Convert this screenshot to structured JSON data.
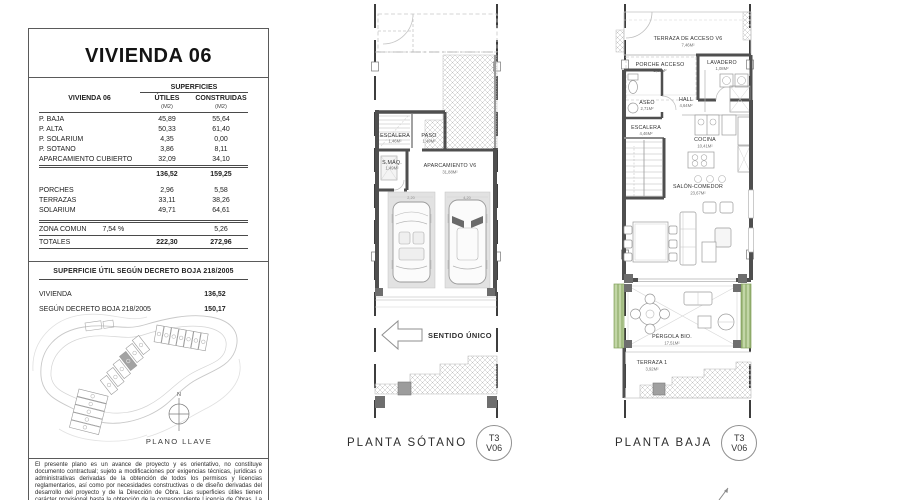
{
  "colors": {
    "wall": "#4f4f4f",
    "hatch": "#bdbdbd",
    "parking_fill": "#e2e2e2",
    "vegetation_green": "#c2d6a6",
    "vegetation_green_line": "#7d9b57",
    "highlight_plot": "#a3a3a3"
  },
  "panel": {
    "title": "VIVIENDA 06",
    "table": {
      "group_header": "SUPERFICIES",
      "row_header": "VIVIENDA 06",
      "col1_header": "ÚTILES",
      "col2_header": "CONSTRUIDAS",
      "unit": "(M2)",
      "rows": [
        {
          "label": "P. BAJA",
          "utiles": "45,89",
          "construidas": "55,64"
        },
        {
          "label": "P. ALTA",
          "utiles": "50,33",
          "construidas": "61,40"
        },
        {
          "label": "P. SOLÁRIUM",
          "utiles": "4,35",
          "construidas": "0,00"
        },
        {
          "label": "P. SÓTANO",
          "utiles": "3,86",
          "construidas": "8,11"
        },
        {
          "label": "APARCAMIENTO CUBIERTO",
          "utiles": "32,09",
          "construidas": "34,10"
        }
      ],
      "subtotal": {
        "utiles": "136,52",
        "construidas": "159,25"
      },
      "rows_outdoor": [
        {
          "label": "PORCHES",
          "utiles": "2,96",
          "construidas": "5,58"
        },
        {
          "label": "TERRAZAS",
          "utiles": "33,11",
          "construidas": "38,26"
        },
        {
          "label": "SOLÁRIUM",
          "utiles": "49,71",
          "construidas": "64,61"
        }
      ],
      "zona_comun": {
        "label": "ZONA COMÚN",
        "pct": "7,54 %",
        "construidas": "5,26"
      },
      "totals": {
        "label": "TOTALES",
        "utiles": "222,30",
        "construidas": "272,96"
      }
    },
    "decreto": {
      "title": "SUPERFICIE ÚTIL SEGÚN DECRETO BOJA 218/2005",
      "rows": [
        {
          "label": "VIVIENDA",
          "value": "136,52"
        },
        {
          "label": "SEGÚN DECRETO BOJA 218/2005",
          "value": "150,17"
        }
      ]
    },
    "key_plan": {
      "north_label": "N",
      "caption": "PLANO LLAVE"
    },
    "disclaimer": "El presente plano es un avance de proyecto y es orientativo, no constituye documento contractual; sujeto a modificaciones por exigencias técnicas, jurídicas o administrativas derivadas de la obtención de todos los permisos y licencias reglamentarios, así como por necesidades constructivas o de diseño derivadas del desarrollo del proyecto y de la Dirección de Obra. Las superficies útiles tienen carácter provisional hasta la obtención de la correspondiente Licencia de Obras. La jardinería, el mobiliario"
  },
  "plan_sotano": {
    "caption": "PLANTA SÓTANO",
    "badge": {
      "type": "T3",
      "unit": "V06"
    },
    "direction_label": "SENTIDO ÚNICO",
    "rooms": [
      {
        "name": "ESCALERA",
        "area": "1,46M²"
      },
      {
        "name": "PASO",
        "area": "1,49M²"
      },
      {
        "name": "S.MÁQ.",
        "area": "1,49M²"
      },
      {
        "name": "APARCAMIENTO V6",
        "area": "31,88M²"
      }
    ],
    "dims": [
      "2,20",
      "4,20"
    ]
  },
  "plan_baja": {
    "caption": "PLANTA BAJA",
    "badge": {
      "type": "T3",
      "unit": "V06"
    },
    "rooms": [
      {
        "name": "TERRAZA DE ACCESO V6",
        "area": "7,46M²"
      },
      {
        "name": "PORCHE ACCESO",
        "area": "2,52M²"
      },
      {
        "name": "LAVADERO",
        "area": "1,08M²"
      },
      {
        "name": "ASEO",
        "area": "2,71M²"
      },
      {
        "name": "HALL",
        "area": "4,64M²"
      },
      {
        "name": "ESCALERA",
        "area": "4,46M²"
      },
      {
        "name": "COCINA",
        "area": "10,41M²"
      },
      {
        "name": "SALÓN-COMEDOR",
        "area": "23,67M²"
      },
      {
        "name": "PÉRGOLA BIO.",
        "area": "17,51M²"
      },
      {
        "name": "TERRAZA 1",
        "area": "3,92M²"
      }
    ]
  }
}
